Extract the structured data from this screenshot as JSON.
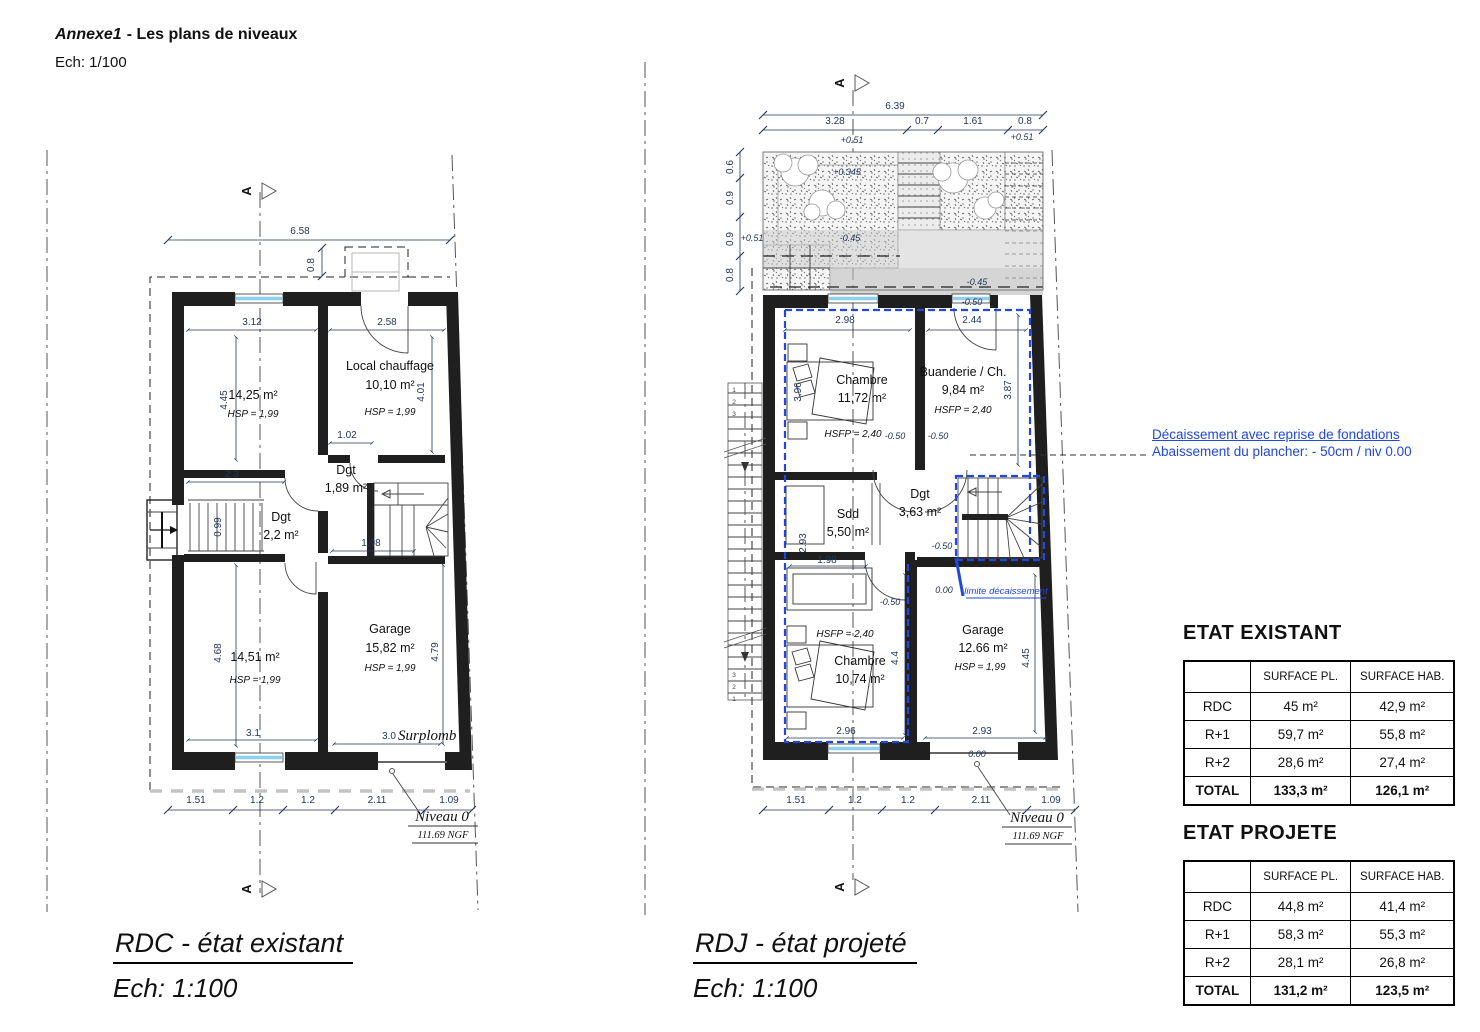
{
  "header": {
    "title_em": "Annexe1",
    "title_rest": "- Les plans de niveaux",
    "scale": "Ech: 1/100"
  },
  "annotation": {
    "line1": "Décaissement avec reprise de fondations",
    "line2": "Abaissement du plancher: - 50cm / niv 0.00"
  },
  "plan_left": {
    "caption": "RDC - état existant",
    "caption_scale": "Ech: 1:100",
    "section_letter": "A",
    "labels": {
      "dim_total": "6.58",
      "dim_overhang": "0.8",
      "dim_room1_w": "3.12",
      "dim_room2_w": "2.58",
      "dim_room1_h": "4.45",
      "dim_room2_h": "4.01",
      "dim_dgt1": "1.02",
      "room1_area": "14,25 m²",
      "room1_hsp": "HSP = 1,99",
      "room2_name": "Local chauffage",
      "room2_area": "10,10 m²",
      "room2_hsp": "HSP = 1,99",
      "dgt1_name": "Dgt",
      "dgt1_area": "1,89 m²",
      "dim_23": "2.3",
      "dgt2_name": "Dgt",
      "dgt2_area": "2,2 m²",
      "dim_099": "0.99",
      "dim_198": "1.98",
      "room3_area": "14,51 m²",
      "room3_hsp": "HSP = 1,99",
      "room4_name": "Garage",
      "room4_area": "15,82 m²",
      "room4_hsp": "HSP = 1,99",
      "dim_room3_h": "4.68",
      "dim_room4_h": "4.79",
      "dim_room3_w": "3.1",
      "dim_room4_w": "3.0",
      "surplomb": "Surplomb",
      "dims_bottom": [
        "1.51",
        "1.2",
        "1.2",
        "2.11",
        "1.09"
      ],
      "level_name": "Niveau 0",
      "level_ngf": "111.69 NGF"
    }
  },
  "plan_right": {
    "caption": "RDJ - état projeté",
    "caption_scale": "Ech: 1:100",
    "section_letter": "A",
    "labels": {
      "dim_total": "6.39",
      "dims_top": [
        "3.28",
        "0.7",
        "1.61",
        "0.8"
      ],
      "lv_p051_r": "+0.51",
      "lv_p051_c": "+0.51",
      "lv_p0345": "+0.345",
      "lv_m045_l": "-0.45",
      "lv_m045_r": "-0.45",
      "lv_m050_top": "-0.50",
      "lv_p051_side": "+0.51",
      "dims_side": [
        "0.6",
        "0.9",
        "0.9",
        "0.8"
      ],
      "dim_ch1_w": "2.98",
      "dim_bu_w": "2.44",
      "ch1_name": "Chambre",
      "ch1_area": "11,72 m²",
      "ch1_hsfp": "HSFP = 2,40",
      "bu_name": "Buanderie / Ch.",
      "bu_area": "9,84 m²",
      "bu_hsfp": "HSFP = 2,40",
      "dim_ch1_h": "3.96",
      "dim_bu_h": "3.87",
      "lv_m050_a": "-0.50",
      "lv_m050_b": "-0.50",
      "lv_m050_c": "-0.50",
      "lv_m050_d": "-0.50",
      "dgt_name": "Dgt",
      "dgt_area": "3,63 m²",
      "sdd_name": "Sdd",
      "sdd_area": "5,50 m²",
      "dim_sdd_h": "2.93",
      "dim_sdd_w": "1.98",
      "lv_000_a": "0.00",
      "lv_000_b": "0.00",
      "limite": "limite décaissement",
      "ch2_hsfp": "HSFP = 2,40",
      "ch2_name": "Chambre",
      "ch2_area": "10,74 m²",
      "dim_ch2_h": "4.4",
      "dim_ga_h": "4.45",
      "ga_name": "Garage",
      "ga_area": "12.66 m²",
      "ga_hsp": "HSP = 1,99",
      "dim_ch2_w": "2.96",
      "dim_ga_w": "2.93",
      "dims_bottom": [
        "1.51",
        "1.2",
        "1.2",
        "2.11",
        "1.09"
      ],
      "stair_top": [
        "1",
        "2",
        "3"
      ],
      "stair_bottom": [
        "3",
        "2",
        "1"
      ],
      "level_name": "Niveau 0",
      "level_ngf": "111.69 NGF"
    }
  },
  "tables": {
    "existant": {
      "title": "ETAT EXISTANT",
      "headers": [
        "",
        "SURFACE PL.",
        "SURFACE HAB."
      ],
      "rows": [
        [
          "RDC",
          "45 m²",
          "42,9 m²"
        ],
        [
          "R+1",
          "59,7 m²",
          "55,8 m²"
        ],
        [
          "R+2",
          "28,6 m²",
          "27,4 m²"
        ],
        [
          "TOTAL",
          "133,3 m²",
          "126,1 m²"
        ]
      ]
    },
    "projete": {
      "title": "ETAT PROJETE",
      "headers": [
        "",
        "SURFACE PL.",
        "SURFACE HAB."
      ],
      "rows": [
        [
          "RDC",
          "44,8 m²",
          "41,4 m²"
        ],
        [
          "R+1",
          "58,3 m²",
          "55,3 m²"
        ],
        [
          "R+2",
          "28,1 m²",
          "26,8 m²"
        ],
        [
          "TOTAL",
          "131,2 m²",
          "123,5 m²"
        ]
      ]
    }
  }
}
